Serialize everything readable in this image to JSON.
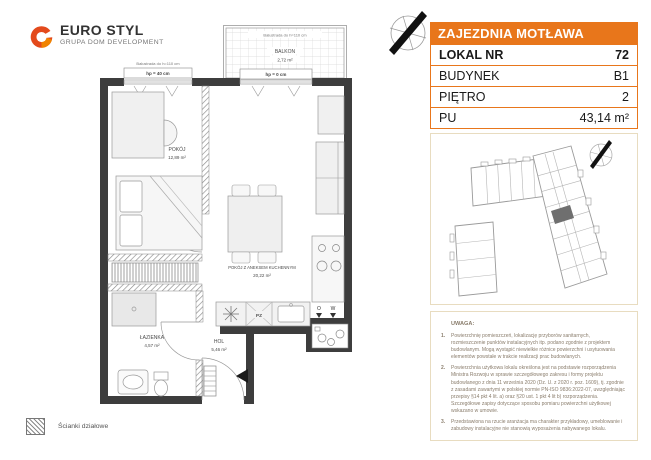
{
  "logo": {
    "brand": "EURO STYL",
    "subtitle": "GRUPA DOM DEVELOPMENT"
  },
  "panel": {
    "header": "ZAJEZDNIA MOTŁAWA",
    "rows": [
      {
        "label": "LOKAL NR",
        "value": "72"
      },
      {
        "label": "BUDYNEK",
        "value": "B1"
      },
      {
        "label": "PIĘTRO",
        "value": "2"
      },
      {
        "label": "PU",
        "value": "43,14 m²"
      }
    ]
  },
  "floorplan": {
    "rooms": [
      {
        "name": "POKÓJ",
        "area": "12,89 m²"
      },
      {
        "name": "POKÓJ Z ANEKSEM KUCHENNYM",
        "area": "20,22 m²"
      },
      {
        "name": "ŁAZIENKA",
        "area": "4,57 m²"
      },
      {
        "name": "HOL",
        "area": "5,46 m²"
      },
      {
        "name": "BALKON",
        "area": "2,72 m²"
      }
    ],
    "annotations": {
      "balustrade": "Balustrada do h=110 cm",
      "hp40": "hp = 40 cm",
      "hp0": "hp = 0 cm",
      "pz": "PZ",
      "o": "O",
      "w": "W"
    }
  },
  "legend": {
    "partition_walls": "Ścianki działowe"
  },
  "notes": {
    "title": "UWAGA:",
    "nums": [
      "1.",
      "2.",
      "3."
    ],
    "items": [
      "Powierzchnię pomieszczeń, lokalizację przyborów sanitarnych, rozmieszczenie punktów instalacyjnych itp. podano zgodnie z projektem budowlanym. Mogą wystąpić niewielkie różnice powierzchni i usytuowania elementów powstałe w trakcie realizacji prac budowlanych.",
      "Powierzchnia użytkowa lokalu określona jest na podstawie rozporządzenia Ministra Rozwoju w sprawie szczegółowego zakresu i formy projektu budowlanego z dnia 11 września 2020 (Dz. U. z 2020 r. poz. 1609), tj. zgodnie z zasadami zawartymi w polskiej normie PN-ISO 9836:2022-07, uwzględniając przepisy §14 pkt 4 lit. a) oraz §20 ust. 1 pkt 4 lit b) rozporządzenia. Szczegółowe zapisy dotyczące sposobu pomiaru powierzchni użytkowej wskazano w umowie.",
      "Przedstawiona na rzucie aranżacja ma charakter przykładowy, umeblowanie i zabudowy instalacyjne nie stanowią wyposażenia nabywanego lokalu."
    ]
  },
  "colors": {
    "accent_orange": "#E8761B",
    "wall": "#3D3D3D",
    "highlight_unit": "#6F6F6F",
    "box_border": "#E8DCC0",
    "logo_red": "#E34A1C",
    "logo_orange": "#F08300"
  }
}
